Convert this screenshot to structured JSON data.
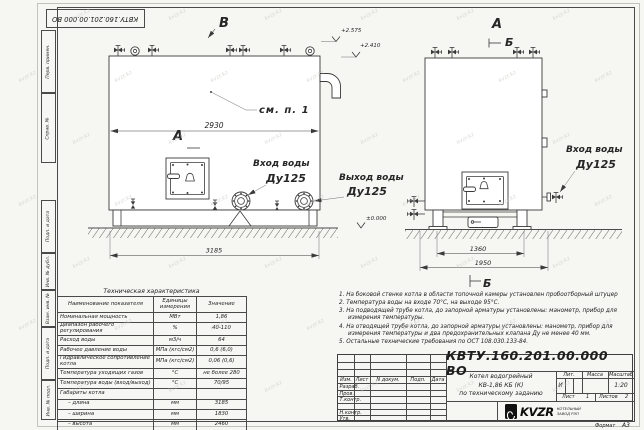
{
  "sheet": {
    "doc_number": "КВТУ.160.201.00.000 ВО",
    "format_label": "Формат",
    "format_value": "А3",
    "side_labels": [
      "Перв. примен.",
      "Справ. №",
      "Подп. и дата",
      "Инв. № дубл.",
      "Взам. инв. №",
      "Подп. и дата",
      "Инв. № подл."
    ],
    "watermark": "kvzr.kz"
  },
  "views": {
    "front": {
      "label": "В",
      "section_label": "А",
      "callout": "см. п. 1",
      "dim_width": "2930",
      "dim_length": "3185",
      "elev_top": "+2.575",
      "elev_flue": "+2.410",
      "elev_zero": "±0.000",
      "inlet_line1": "Вход воды",
      "inlet_line2": "Ду125",
      "outlet_line1": "Выход воды",
      "outlet_line2": "Ду125"
    },
    "side": {
      "label": "А",
      "section_label": "Б",
      "section_label_bottom": "Б",
      "dim_inner": "1360",
      "dim_outer": "1950",
      "inlet_line1": "Вход воды",
      "inlet_line2": "Ду125"
    }
  },
  "spec_table": {
    "title": "Техническая характеристика",
    "headers": [
      "Наименование показателя",
      "Единицы измерения",
      "Значение"
    ],
    "rows": [
      {
        "name": "Номинальная мощность",
        "unit": "МВт",
        "value": "1,86"
      },
      {
        "name": "Диапазон рабочего регулирования",
        "unit": "%",
        "value": "40-110"
      },
      {
        "name": "Расход воды",
        "unit": "м3/ч",
        "value": "64"
      },
      {
        "name": "Рабочее давление воды",
        "unit": "МПа (кгс/см2)",
        "value": "0,6 (6,0)"
      },
      {
        "name": "Гидравлическое сопротивление котла",
        "unit": "МПа (кгс/см2)",
        "value": "0,06 (0,6)"
      },
      {
        "name": "Температура уходящих газов",
        "unit": "°С",
        "value": "не более 280"
      },
      {
        "name": "Температура воды (вход/выход)",
        "unit": "°С",
        "value": "70/95"
      },
      {
        "name": "Габариты котла",
        "unit": "",
        "value": ""
      },
      {
        "name": "– длина",
        "unit": "мм",
        "value": "3185"
      },
      {
        "name": "– ширина",
        "unit": "мм",
        "value": "1830"
      },
      {
        "name": "– высота",
        "unit": "мм",
        "value": "2460"
      }
    ]
  },
  "notes": [
    "1.  На боковой стенке котла в области топочной камеры установлен пробоотборный штуцер",
    "2.  Температура воды на входе 70°С, на выходе 95°С.",
    "3.  На подводящей трубе котла, до запорной арматуры установлены: манометр, прибор для измерения температуры.",
    "4.  На отводящей трубе котла, до запорной арматуры установлены: манометр, прибор для измерения температуры и два предохранительных клапана  Ду не менее 40 мм.",
    "5.  Остальные технические требования по ОСТ 108.030.133-84."
  ],
  "title_block": {
    "doc_number": "КВТУ.160.201.00.000  ВО",
    "product_lines": [
      "Котел водогрейный",
      "КВ-1,86 КБ (К)",
      "по техническому заданию"
    ],
    "columns": [
      "Изм.",
      "Лист",
      "N докум.",
      "Подп.",
      "Дата"
    ],
    "rows": [
      "Разраб.",
      "Пров.",
      "Т.контр.",
      "",
      "Н.контр.",
      "Утв."
    ],
    "lit_label": "Лит.",
    "mass_label": "Масса",
    "scale_label": "Масштаб",
    "lit_value": "И",
    "mass_value": "",
    "scale_value": "1:20",
    "sheet_label": "Лист",
    "sheet_value": "1",
    "sheets_label": "Листов",
    "sheets_value": "2",
    "logo_text": "KVZR",
    "org_line1": "КОТЕЛЬНЫЙ",
    "org_line2": "ЗАВОД РЭП"
  }
}
